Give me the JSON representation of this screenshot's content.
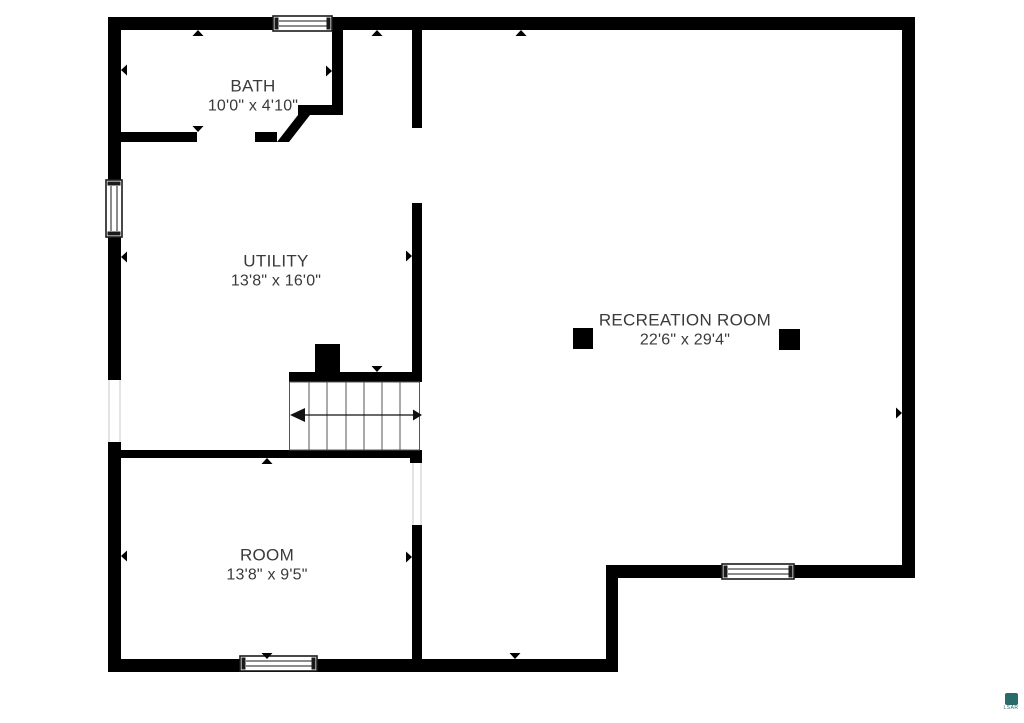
{
  "rooms": [
    {
      "name": "BATH",
      "dims": "10'0\" x 4'10\""
    },
    {
      "name": "UTILITY",
      "dims": "13'8\" x 16'0\""
    },
    {
      "name": "RECREATION ROOM",
      "dims": "22'6\" x 29'4\""
    },
    {
      "name": "ROOM",
      "dims": "13'8\" x 9'5\""
    }
  ],
  "stairs": {
    "treads": 7,
    "direction": "left"
  },
  "features": {
    "windows": 4,
    "wall_openings": 2,
    "posts": 2,
    "chimney": 1
  },
  "watermark": {
    "text": "LSAR"
  },
  "colors": {
    "background": "#ffffff",
    "wall": "#000000",
    "text": "#3a3a3a",
    "stair_line": "#555555",
    "opening_outline": "#c9c9c9",
    "watermark_teal": "#2a6a6a"
  }
}
